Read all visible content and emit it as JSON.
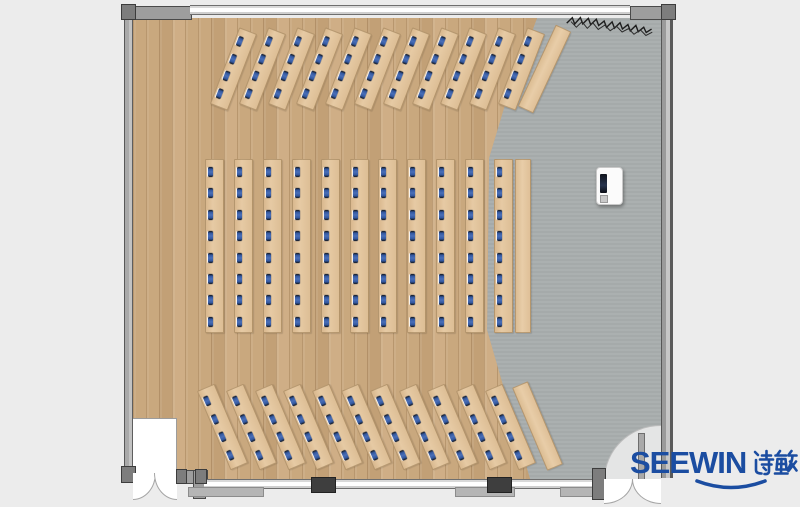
{
  "logo": {
    "text_en": "SEEWIN",
    "text_cn": "诗敏",
    "color": "#1B4DA1"
  },
  "palette": {
    "background": "#ECECEC",
    "wood_floor": "#C9A77D",
    "stage_floor": "#A8ADAD",
    "desk": "#E2C49C",
    "seat_marker": "#33589F",
    "wall": "#9E9E9E",
    "wall_outline": "#4A4A4A",
    "column": "#3E3E3E"
  },
  "floor_plan": {
    "room": {
      "x": 121,
      "y": 4,
      "width": 552,
      "height": 500
    },
    "areas": [
      {
        "name": "wood-floor",
        "description": "timber plank seating area"
      },
      {
        "name": "stage-area",
        "description": "grey platform on right side"
      }
    ],
    "desk_groups": [
      {
        "id": "top-fan",
        "rows": 11,
        "seats_per_row": 4,
        "rotation_deg": 21,
        "layout": {
          "origin_x": 224,
          "origin_y": 28,
          "spacing": 28.8,
          "strip_w": 17,
          "strip_h": 80,
          "mark_start": 7,
          "mark_step": 18.5
        },
        "side_table": {
          "x": 536,
          "y": 24,
          "w": 15,
          "h": 88,
          "rot": 25
        }
      },
      {
        "id": "middle-straight",
        "rows": 11,
        "seats_per_row": 8,
        "rotation_deg": 0,
        "layout": {
          "origin_x": 205,
          "origin_y": 159,
          "spacing": 28.9,
          "strip_w": 17,
          "strip_h": 172,
          "mark_start": 7,
          "mark_step": 21.4
        },
        "side_table": {
          "x": 515,
          "y": 159,
          "w": 14,
          "h": 172,
          "rot": 0
        }
      },
      {
        "id": "bottom-fan",
        "rows": 11,
        "seats_per_row": 4,
        "rotation_deg": -23,
        "layout": {
          "origin_x": 213,
          "origin_y": 384,
          "spacing": 28.8,
          "strip_w": 17,
          "strip_h": 84,
          "mark_start": 7,
          "mark_step": 19.5
        },
        "side_table": {
          "x": 529,
          "y": 381,
          "w": 15,
          "h": 88,
          "rot": -23
        }
      }
    ],
    "totals": {
      "desk_rows": 33,
      "side_tables": 3,
      "seats": 176
    },
    "objects": [
      "water-dispenser",
      "storage-room-bottom-left",
      "double-door-bottom-left",
      "double-door-bottom-right",
      "window-wall-top",
      "window-wall-bottom",
      "structural-column-1",
      "structural-column-2",
      "sketch-annotation-top-right"
    ]
  }
}
